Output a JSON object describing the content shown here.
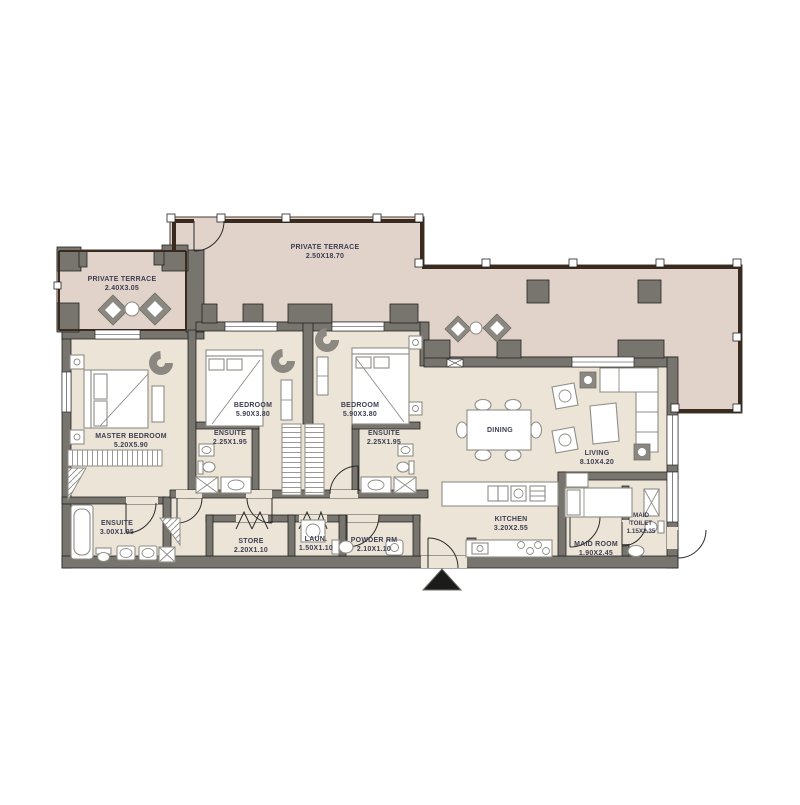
{
  "title": "apartment-floor-plan",
  "colors": {
    "terrace_floor": "#e1d3ca",
    "interior_floor": "#ece5d7",
    "wall": "#77756e",
    "railing": "#3a2b20",
    "label_text": "#3d3e52",
    "furniture_stroke": "#8f8d86"
  },
  "markers": {
    "entrance": "entrance-arrow-icon"
  },
  "labels": [
    {
      "id": "terrace-left",
      "lines": [
        "PRIVATE TERRACE",
        "2.40X3.05"
      ]
    },
    {
      "id": "terrace-top",
      "lines": [
        "PRIVATE TERRACE",
        "2.50X18.70"
      ]
    },
    {
      "id": "master-bedroom",
      "lines": [
        "MASTER BEDROOM",
        "5.20X5.90"
      ]
    },
    {
      "id": "bedroom-2",
      "lines": [
        "BEDROOM",
        "5.90X3.80"
      ]
    },
    {
      "id": "ensuite-2",
      "lines": [
        "ENSUITE",
        "2.25X1.95"
      ]
    },
    {
      "id": "bedroom-3",
      "lines": [
        "BEDROOM",
        "5.90X3.80"
      ]
    },
    {
      "id": "ensuite-3",
      "lines": [
        "ENSUITE",
        "2.25X1.95"
      ]
    },
    {
      "id": "master-ensuite",
      "lines": [
        "ENSUITE",
        "3.00X1.95"
      ]
    },
    {
      "id": "dining",
      "lines": [
        "DINING"
      ]
    },
    {
      "id": "living",
      "lines": [
        "LIVING",
        "8.10X4.20"
      ]
    },
    {
      "id": "kitchen",
      "lines": [
        "KITCHEN",
        "3.20X2.55"
      ]
    },
    {
      "id": "maid-room",
      "lines": [
        "MAID ROOM",
        "1.90X2.45"
      ]
    },
    {
      "id": "maid-toilet",
      "lines": [
        "MAID",
        "TOILET",
        "1.15X2.35"
      ]
    },
    {
      "id": "store",
      "lines": [
        "STORE",
        "2.20X1.10"
      ]
    },
    {
      "id": "laundry",
      "lines": [
        "LAUN.",
        "1.50X1.10"
      ]
    },
    {
      "id": "powder-room",
      "lines": [
        "POWDER RM",
        "2.10X1.10"
      ]
    }
  ]
}
